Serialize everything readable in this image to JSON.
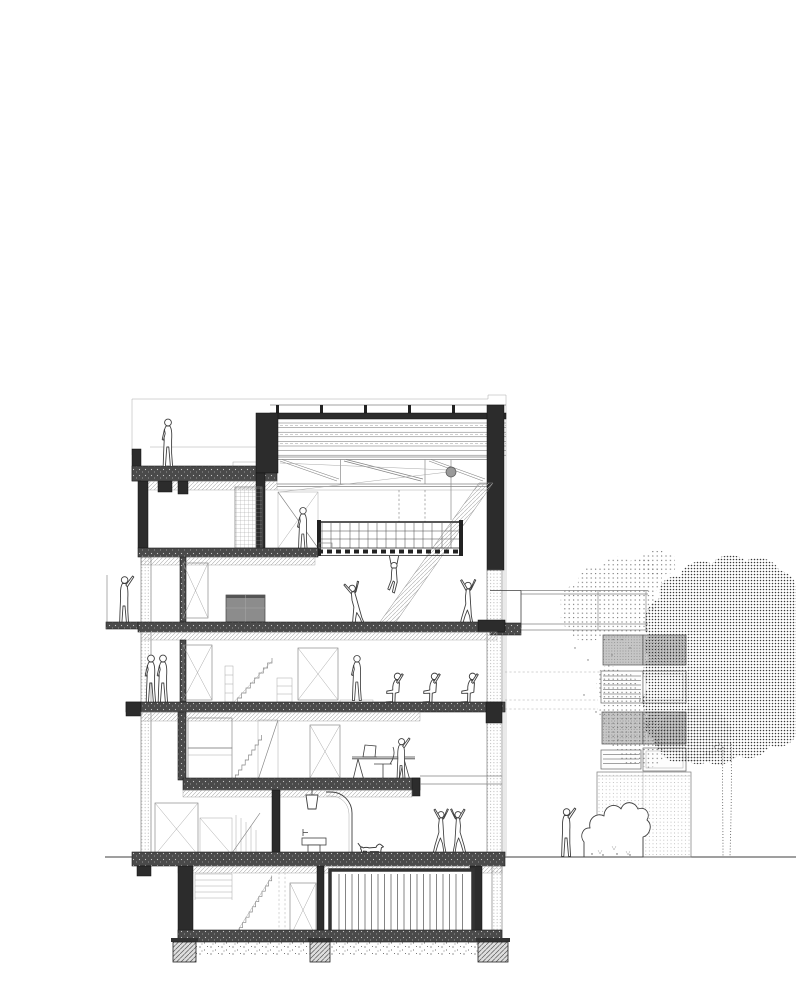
{
  "meta": {
    "drawing_type": "architectural-building-section",
    "style": "black-and-white line drawing with hatching and stipple",
    "orientation": "section cut through five storeys plus basement, garden with tree at right"
  },
  "colors": {
    "background": "#ffffff",
    "ink": "#3f3f3f",
    "wall_dark": "#2c2c2c",
    "slab_fill": "#4a4a4a",
    "stipple_gray": "#8a8a8a",
    "hatch_gray": "#adadad",
    "panel_gray": "#c6c6c6",
    "tree_dense_dot": "#3a3a3a",
    "tree_light_dot": "#6e6e6e",
    "media_box_gray": "#8c8c8c"
  },
  "building": {
    "levels": [
      {
        "name": "roof-terrace",
        "elements": [
          "parapet",
          "terrace-slab",
          "bench",
          "standing-person"
        ]
      },
      {
        "name": "double-height-studio",
        "elements": [
          "layered-roof-buildup",
          "roof-posts",
          "steel-truss",
          "mesh-screen",
          "braced-glass-partition",
          "pendant-lamp",
          "suspended-catwalk-with-railing",
          "hatched-stair-flight",
          "standing-person",
          "hanging-acrobat"
        ]
      },
      {
        "name": "upper-bedroom-level",
        "elements": [
          "left-balcony-person",
          "wardrobe-x-panel",
          "media-cabinet",
          "two-dancing-figures"
        ]
      },
      {
        "name": "mid-level",
        "elements": [
          "two-standing-people",
          "wardrobe-x-panel",
          "stair-flight",
          "x-braced-door",
          "standing-person-on-plinth",
          "three-seated-people",
          "right-balcony",
          "walkway-railings"
        ]
      },
      {
        "name": "split-office-level",
        "elements": [
          "partition",
          "cabinet-boxes",
          "stair-flight",
          "braced-panel",
          "x-braced-door",
          "desk",
          "laptop",
          "office-chair",
          "person-at-desk"
        ]
      },
      {
        "name": "ground-floor",
        "elements": [
          "wardrobe-x-panel",
          "low-cabinet",
          "stair-flight",
          "partition",
          "pendant-lamp",
          "wash-basin",
          "arched-opening",
          "dog",
          "two-dancing-figures"
        ]
      },
      {
        "name": "basement",
        "elements": [
          "shelving",
          "stair-flight",
          "x-braced-door",
          "slatted-storage-wall",
          "gravel-bed",
          "three-footings"
        ]
      }
    ]
  },
  "site": {
    "ground_line": "continuous horizontal datum line",
    "neighbor_facade": {
      "bands": [
        "walkway-railing-lines",
        "gray-stipple-panel-row",
        "louver-band",
        "gray-stipple-panel-row",
        "louver-band",
        "stippled-base-volume"
      ]
    },
    "tree": {
      "parts": [
        "light-stipple-canopy",
        "dense-stipple-canopy",
        "dotted-trunk"
      ]
    },
    "bush": "scalloped shrub outline at grade",
    "figures": [
      "pointing-person"
    ]
  }
}
